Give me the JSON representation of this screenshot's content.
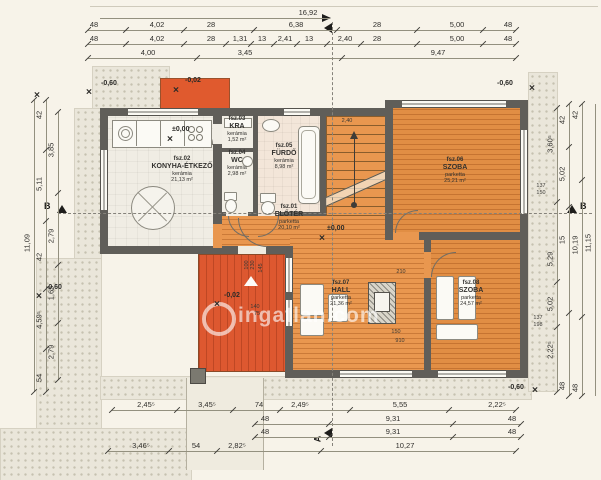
{
  "watermark": {
    "text": "ingatlan.com"
  },
  "markers": {
    "a": "A",
    "b": "B"
  },
  "rooms": [
    {
      "id": "fsz.01",
      "name": "ELŐTÉR",
      "material": "parketta",
      "area": "20,10 m²",
      "cx": 289,
      "cy": 218
    },
    {
      "id": "fsz.02",
      "name": "KONYHA-ÉTKEZŐ",
      "material": "kerámia",
      "area": "21,13 m²",
      "cx": 182,
      "cy": 170
    },
    {
      "id": "fsz.03",
      "name": "KRA",
      "material": "kerámia",
      "area": "1,52 m²",
      "cx": 237,
      "cy": 130
    },
    {
      "id": "fsz.04",
      "name": "WC",
      "material": "kerámia",
      "area": "2,98 m²",
      "cx": 237,
      "cy": 164
    },
    {
      "id": "fsz.05",
      "name": "FÜRDŐ",
      "material": "kerámia",
      "area": "8,98 m²",
      "cx": 284,
      "cy": 157
    },
    {
      "id": "fsz.06",
      "name": "SZOBA",
      "material": "parketta",
      "area": "25,21 m²",
      "cx": 455,
      "cy": 171
    },
    {
      "id": "fsz.07",
      "name": "HALL",
      "material": "parketta",
      "area": "21,36 m²",
      "cx": 341,
      "cy": 294
    },
    {
      "id": "fsz.08",
      "name": "SZOBA",
      "material": "parketta",
      "area": "24,57 m²",
      "cx": 471,
      "cy": 294
    }
  ],
  "levels": [
    {
      "t": "-0,60",
      "x": 101,
      "y": 80,
      "ix": 89,
      "iy": 92
    },
    {
      "t": "",
      "x": 0,
      "y": 0,
      "ix": 37,
      "iy": 95
    },
    {
      "t": "-0,60",
      "x": 497,
      "y": 80,
      "ix": 532,
      "iy": 88
    },
    {
      "t": "-0,60",
      "x": 508,
      "y": 384,
      "ix": 535,
      "iy": 390
    },
    {
      "t": "-0,60",
      "x": 46,
      "y": 284,
      "ix": 39,
      "iy": 296
    },
    {
      "t": "-0,02",
      "x": 185,
      "y": 77,
      "ix": 176,
      "iy": 90
    },
    {
      "t": "-0,02",
      "x": 224,
      "y": 292,
      "ix": 217,
      "iy": 304
    },
    {
      "t": "±0,00",
      "x": 172,
      "y": 126,
      "ix": 170,
      "iy": 139
    },
    {
      "t": "±0,00",
      "x": 327,
      "y": 225,
      "ix": 322,
      "iy": 238
    }
  ],
  "dim_rows": [
    {
      "o": "h",
      "y": 18,
      "x1": 100,
      "x2": 330,
      "ticks": false,
      "labels": [
        {
          "t": "16,92",
          "x": 308
        }
      ]
    },
    {
      "o": "h",
      "y": 30,
      "x1": 88,
      "x2": 516,
      "labels": [
        {
          "t": "48",
          "x": 94
        },
        {
          "t": "4,02",
          "x": 157
        },
        {
          "t": "28",
          "x": 211
        },
        {
          "t": "6,38",
          "x": 296
        },
        {
          "t": "28",
          "x": 377
        },
        {
          "t": "5,00",
          "x": 457
        },
        {
          "t": "48",
          "x": 508
        }
      ]
    },
    {
      "o": "h",
      "y": 44,
      "x1": 88,
      "x2": 516,
      "labels": [
        {
          "t": "48",
          "x": 94
        },
        {
          "t": "4,02",
          "x": 157
        },
        {
          "t": "28",
          "x": 211
        },
        {
          "t": "1,31",
          "x": 240
        },
        {
          "t": "13",
          "x": 262
        },
        {
          "t": "2,41",
          "x": 285
        },
        {
          "t": "13",
          "x": 309
        },
        {
          "t": "2,40",
          "x": 345
        },
        {
          "t": "28",
          "x": 377
        },
        {
          "t": "5,00",
          "x": 457
        },
        {
          "t": "48",
          "x": 508
        }
      ]
    },
    {
      "o": "h",
      "y": 58,
      "x1": 88,
      "x2": 516,
      "labels": [
        {
          "t": "4,00",
          "x": 148
        },
        {
          "t": "3,45",
          "x": 245
        },
        {
          "t": "9,47",
          "x": 438
        }
      ]
    },
    {
      "o": "h",
      "y": 410,
      "x1": 112,
      "x2": 516,
      "labels": [
        {
          "t": "2,45⁵",
          "x": 146
        },
        {
          "t": "3,45⁵",
          "x": 207
        },
        {
          "t": "74",
          "x": 259
        },
        {
          "t": "2,49⁵",
          "x": 300
        },
        {
          "t": "5,55",
          "x": 400
        },
        {
          "t": "2,22⁵",
          "x": 497
        }
      ]
    },
    {
      "o": "h",
      "y": 424,
      "x1": 255,
      "x2": 521,
      "labels": [
        {
          "t": "48",
          "x": 265
        },
        {
          "t": "9,31",
          "x": 393
        },
        {
          "t": "48",
          "x": 512
        }
      ]
    },
    {
      "o": "h",
      "y": 437,
      "x1": 255,
      "x2": 521,
      "labels": [
        {
          "t": "48",
          "x": 265
        },
        {
          "t": "9,31",
          "x": 393
        },
        {
          "t": "48",
          "x": 512
        }
      ]
    },
    {
      "o": "h",
      "y": 451,
      "x1": 108,
      "x2": 516,
      "labels": [
        {
          "t": "3,46⁵",
          "x": 141
        },
        {
          "t": "54",
          "x": 196
        },
        {
          "t": "2,82⁵",
          "x": 237
        },
        {
          "t": "10,27",
          "x": 405
        }
      ]
    },
    {
      "o": "v",
      "x": 34,
      "y1": 100,
      "y2": 392,
      "labels": [
        {
          "t": "11,09",
          "y": 243
        }
      ]
    },
    {
      "o": "v",
      "x": 46,
      "y1": 100,
      "y2": 392,
      "labels": [
        {
          "t": "42",
          "y": 115
        },
        {
          "t": "5,11",
          "y": 184
        },
        {
          "t": "42",
          "y": 257
        },
        {
          "t": "4,59⁵",
          "y": 320
        },
        {
          "t": "54",
          "y": 378
        }
      ]
    },
    {
      "o": "v",
      "x": 58,
      "y1": 112,
      "y2": 380,
      "labels": [
        {
          "t": "3,85",
          "y": 150
        },
        {
          "t": "2,79",
          "y": 236
        },
        {
          "t": "1,65",
          "y": 293
        },
        {
          "t": "2,79",
          "y": 352
        }
      ]
    },
    {
      "o": "v",
      "x": 557,
      "y1": 108,
      "y2": 392,
      "labels": [
        {
          "t": "3,60⁵",
          "y": 144
        },
        {
          "t": "5,29",
          "y": 259
        },
        {
          "t": "5,02",
          "y": 304
        },
        {
          "t": "2,22⁵",
          "y": 350
        }
      ]
    },
    {
      "o": "v",
      "x": 569,
      "y1": 104,
      "y2": 396,
      "labels": [
        {
          "t": "42",
          "y": 120
        },
        {
          "t": "5,02",
          "y": 174
        },
        {
          "t": "15",
          "y": 240
        },
        {
          "t": "48",
          "y": 386
        }
      ]
    },
    {
      "o": "v",
      "x": 582,
      "y1": 104,
      "y2": 396,
      "labels": [
        {
          "t": "42",
          "y": 115
        },
        {
          "t": "10,19",
          "y": 245
        },
        {
          "t": "48",
          "y": 388
        }
      ]
    },
    {
      "o": "v",
      "x": 595,
      "y1": 104,
      "y2": 396,
      "ticks": false,
      "labels": [
        {
          "t": "11,15",
          "y": 243
        }
      ]
    }
  ],
  "tiny_labels": [
    {
      "t": "2,40",
      "x": 347,
      "y": 121
    },
    {
      "t": "210",
      "x": 401,
      "y": 272
    },
    {
      "t": "150",
      "x": 396,
      "y": 332
    },
    {
      "t": "910",
      "x": 400,
      "y": 341
    },
    {
      "t": "137",
      "x": 541,
      "y": 186
    },
    {
      "t": "150",
      "x": 541,
      "y": 193
    },
    {
      "t": "137",
      "x": 538,
      "y": 318
    },
    {
      "t": "198",
      "x": 538,
      "y": 325
    },
    {
      "t": "100",
      "x": 247,
      "y": 265,
      "rot": -90
    },
    {
      "t": "230",
      "x": 253,
      "y": 265,
      "rot": -90
    },
    {
      "t": "145",
      "x": 261,
      "y": 268,
      "rot": -90
    },
    {
      "t": "140",
      "x": 255,
      "y": 307
    },
    {
      "t": "75",
      "x": 257,
      "y": 314
    }
  ]
}
